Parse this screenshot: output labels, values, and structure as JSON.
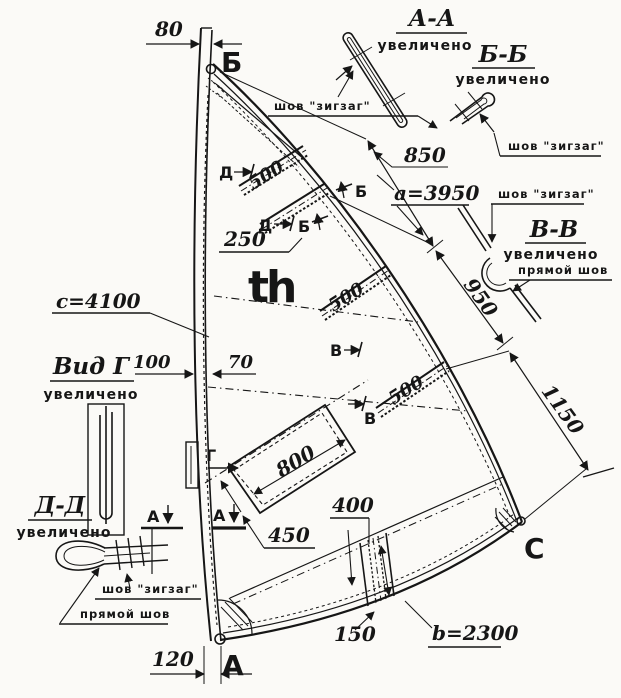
{
  "colors": {
    "ink": "#161616",
    "paper": "#fbfaf7"
  },
  "sail": {
    "head": "Б",
    "tack": "А",
    "clew": "C",
    "logo": "th"
  },
  "dims": {
    "mast_top": "80",
    "mast_bottom": "120",
    "sleeve_outer": "100",
    "sleeve_inner": "70",
    "batten_len": "500",
    "batten_gap": "250",
    "leech_seg1": "850",
    "leech_seg2": "950",
    "leech_seg3": "1150",
    "leech_total": "a=3950",
    "luff_total": "c=4100",
    "foot_total": "b=2300",
    "window_len": "800",
    "window_offset": "450",
    "foot_batten_len": "400",
    "foot_batten_off": "150"
  },
  "notes": {
    "zigzag": "шов \"зигзаг\"",
    "straight": "прямой шов",
    "enlarged": "увеличено"
  },
  "details": {
    "aa": "А-А",
    "bb": "Б-Б",
    "vv": "В-В",
    "vid_g": "Вид Г",
    "dd": "Д-Д"
  },
  "marks": {
    "a": "А",
    "b": "Б",
    "v": "В",
    "g": "Г",
    "d": "Д"
  }
}
